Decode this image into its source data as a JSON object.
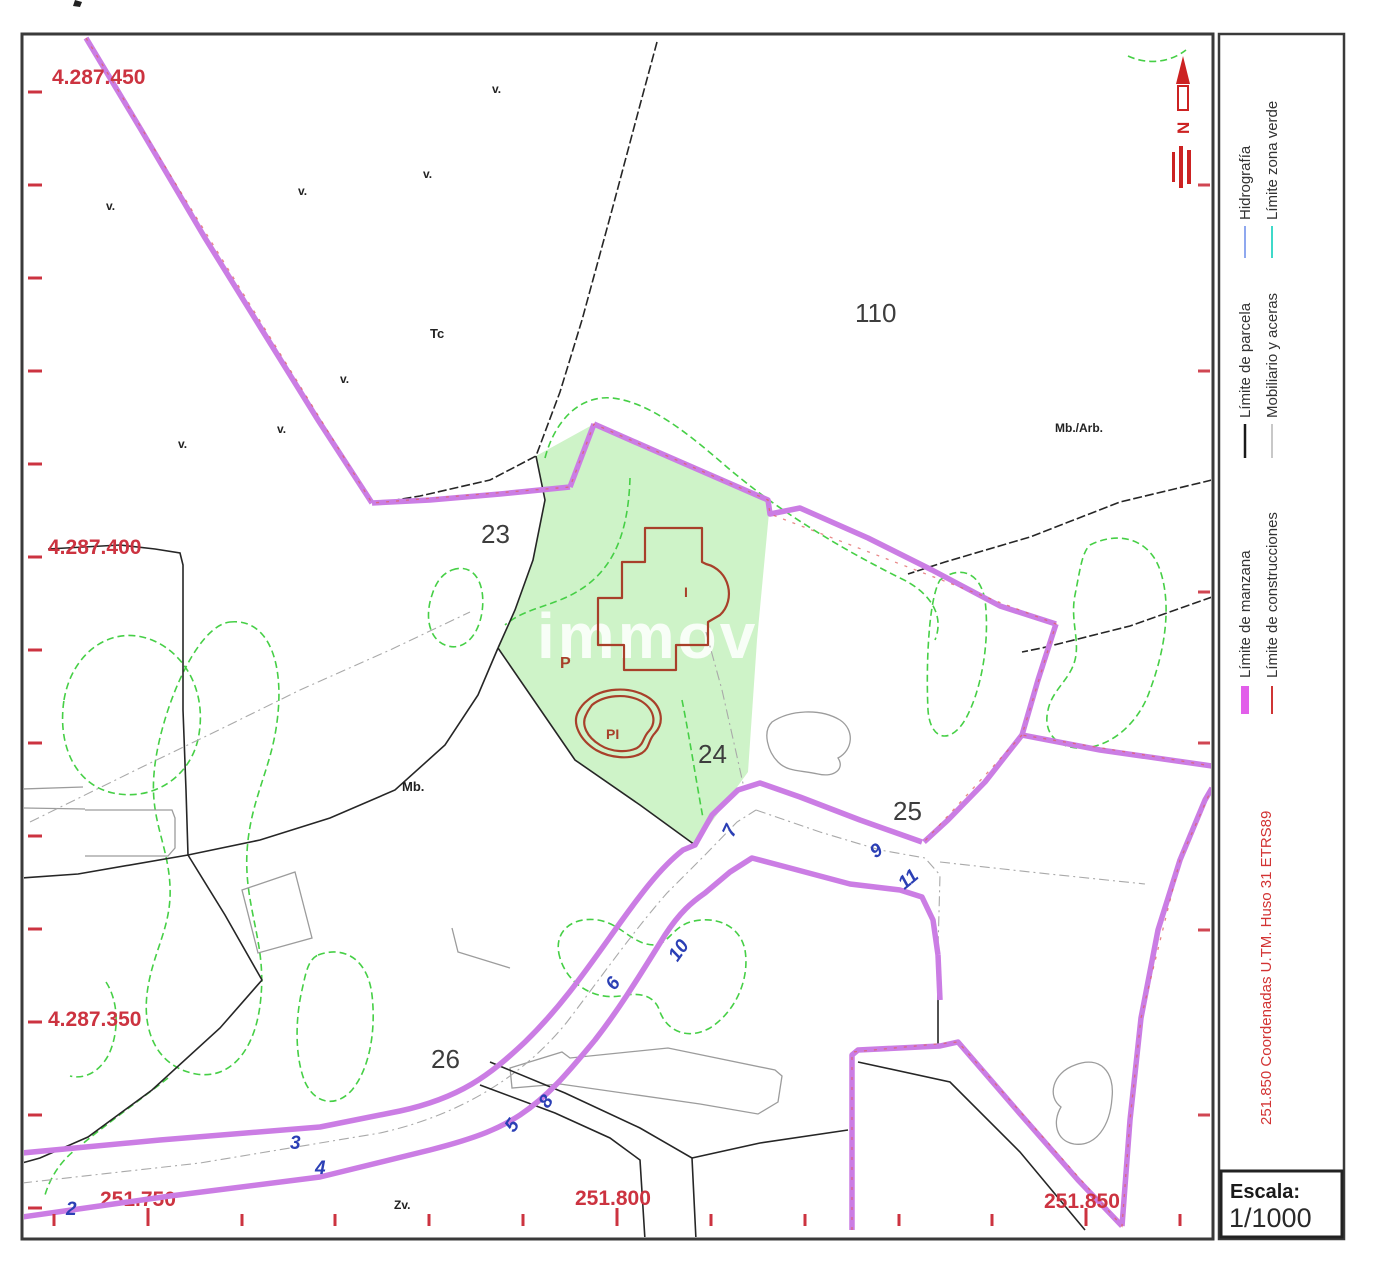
{
  "map": {
    "parcel_labels": [
      "23",
      "24",
      "25",
      "26",
      "110"
    ],
    "coords_left": [
      "4.287.450",
      "4.287.400",
      "4.287.350"
    ],
    "coords_bottom": [
      "251.750",
      "251.800",
      "251.850"
    ],
    "road_numbers": [
      "2",
      "3",
      "4",
      "5",
      "8",
      "6",
      "10",
      "7",
      "9",
      "11"
    ],
    "annotations": {
      "v": "v.",
      "tc": "Tc",
      "mb": "Mb.",
      "mb_arb": "Mb./Arb.",
      "zv": "Zv.",
      "p": "P",
      "pool": "PI",
      "building": "I"
    },
    "north_letter": "N",
    "watermark": "immovi"
  },
  "legend": {
    "items": [
      {
        "label": "Límite de parcela",
        "color": "#1a1a1a"
      },
      {
        "label": "Mobiliario y aceras",
        "color": "#b5b5b5"
      },
      {
        "label": "Hidrografía",
        "color": "#8fa8ef"
      },
      {
        "label": "Límite zona verde",
        "color": "#3fd9c9"
      },
      {
        "label": "Límite de manzana",
        "color": "#e25fea"
      },
      {
        "label": "Límite de construcciones",
        "color": "#cf3535"
      }
    ],
    "note": "251.850 Coordenadas U.TM. Huso 31 ETRS89",
    "scale_label": "Escala:",
    "scale_value": "1/1000"
  },
  "colors": {
    "manzana": "#cb7de4",
    "zona_verde": "#46cf46",
    "zona_verde_fill": "#cef3c8",
    "construcciones": "#a8402a",
    "coordenadas": "#cc3340",
    "numeros": "#2b3fb5",
    "parcela": "#262626",
    "mobiliario": "#9c9c9c"
  }
}
